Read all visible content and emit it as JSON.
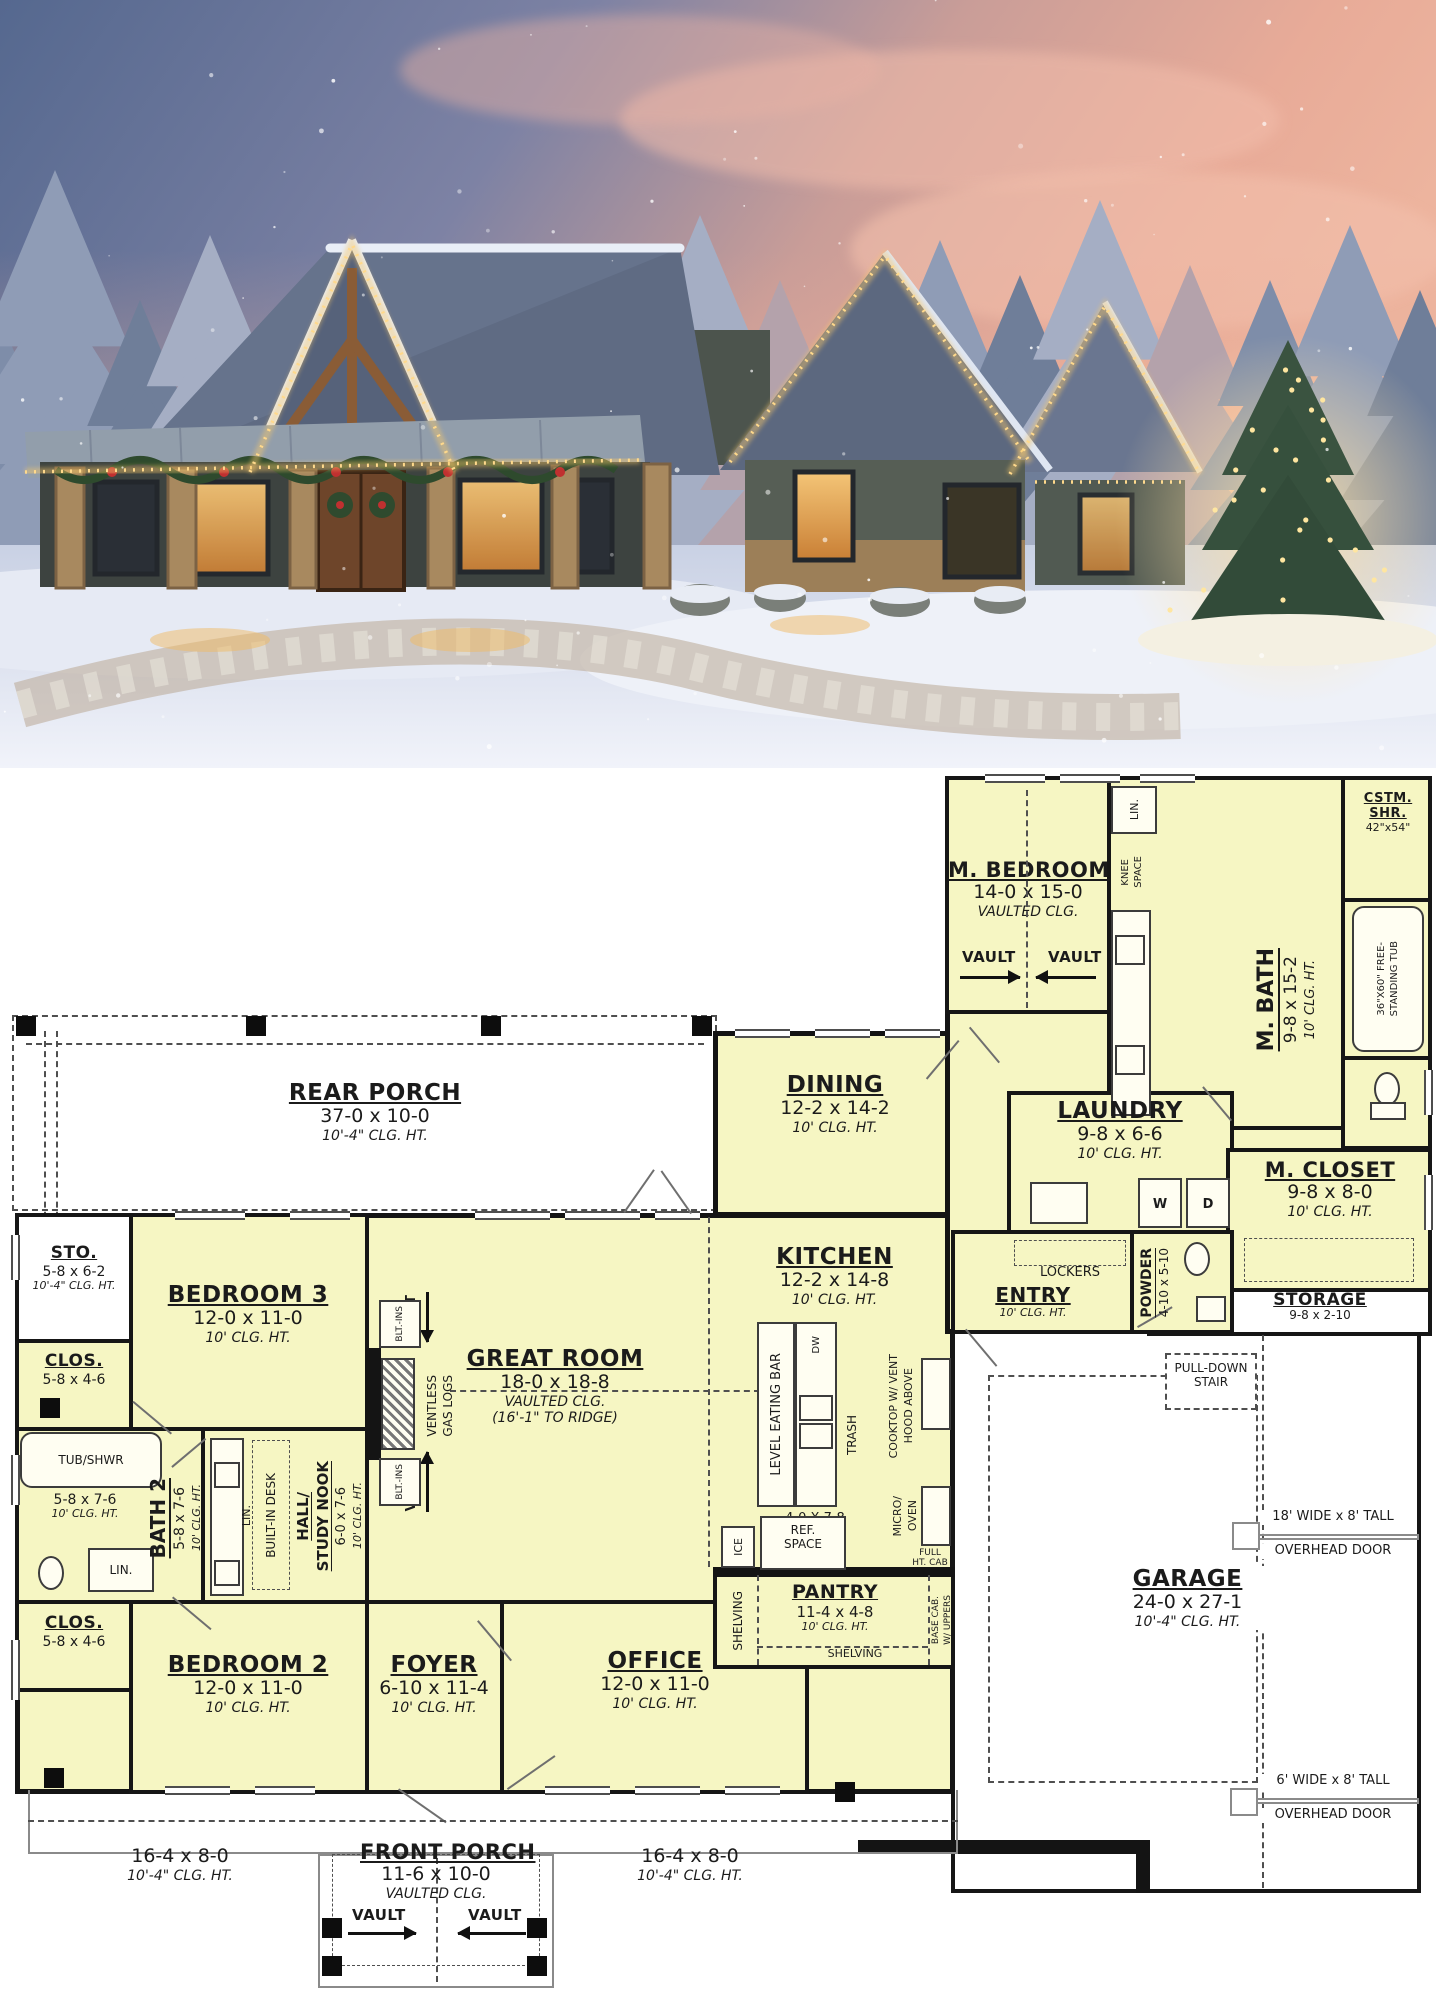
{
  "palette": {
    "plan_room_fill": "#f6f6c3",
    "plan_wall": "#141414",
    "plan_bg": "#ffffff",
    "plan_dash": "#4f4f4f",
    "sky_blue": "#55688f",
    "sky_pink": "#edb49e",
    "tree_frost": "#8795b2",
    "snow": "#e6eaf4",
    "roof_slate": "#5c687f",
    "porch_metal": "#929eb1",
    "stone": "#a8895f",
    "timber": "#8a5c36",
    "window_glow": "#f2c171",
    "lights_warm": "#ffd98c",
    "garland": "#2e4a2d",
    "door_wood": "#6e452a"
  },
  "photo": {
    "scene": "snowy dusk farmhouse with christmas lights and lit tree"
  },
  "plan": {
    "rooms": {
      "rear_porch": {
        "name": "REAR PORCH",
        "dims": "37-0 x 10-0",
        "clg": "10'-4\" CLG. HT."
      },
      "m_bedroom": {
        "name": "M. BEDROOM",
        "dims": "14-0 x 15-0",
        "clg": "VAULTED CLG."
      },
      "m_bath": {
        "name": "M. BATH",
        "dims": "9-8 x 15-2",
        "clg": "10' CLG. HT."
      },
      "cstm_shr": {
        "l1": "CSTM.",
        "l2": "SHR.",
        "dims": "42\"x54\""
      },
      "free_tub": {
        "l1": "36\"X60\" FREE-",
        "l2": "STANDING TUB"
      },
      "dining": {
        "name": "DINING",
        "dims": "12-2 x 14-2",
        "clg": "10' CLG. HT."
      },
      "laundry": {
        "name": "LAUNDRY",
        "dims": "9-8 x 6-6",
        "clg": "10' CLG. HT."
      },
      "m_closet": {
        "name": "M. CLOSET",
        "dims": "9-8 x 8-0",
        "clg": "10' CLG. HT."
      },
      "sto": {
        "name": "STO.",
        "dims": "5-8 x 6-2",
        "clg": "10'-4\" CLG. HT."
      },
      "bedroom3": {
        "name": "BEDROOM 3",
        "dims": "12-0 x 11-0",
        "clg": "10' CLG. HT."
      },
      "clos_top": {
        "name": "CLOS.",
        "dims": "5-8 x 4-6"
      },
      "clos_bottom": {
        "name": "CLOS.",
        "dims": "5-8 x 4-6"
      },
      "bath2": {
        "name": "BATH 2",
        "dims": "5-8 x 7-6",
        "clg": "10' CLG. HT."
      },
      "bath2_inline": {
        "dims": "5-8 x 7-6",
        "clg": "10' CLG. HT."
      },
      "hall": {
        "l1": "HALL/",
        "l2": "STUDY NOOK",
        "dims": "6-0 x 7-6",
        "clg": "10' CLG. HT."
      },
      "great_room": {
        "name": "GREAT ROOM",
        "dims": "18-0 x 18-8",
        "clg": "VAULTED CLG.",
        "clg2": "(16'-1\" TO RIDGE)"
      },
      "kitchen": {
        "name": "KITCHEN",
        "dims": "12-2 x 14-8",
        "clg": "10' CLG. HT."
      },
      "island": {
        "dims": "4-0 X 7-8",
        "name": "ISLAND"
      },
      "pantry": {
        "name": "PANTRY",
        "dims": "11-4 x 4-8",
        "clg": "10' CLG. HT."
      },
      "entry": {
        "name": "ENTRY",
        "clg": "10' CLG. HT."
      },
      "powder": {
        "name": "POWDER",
        "dims": "4-10 x 5-10"
      },
      "storage": {
        "name": "STORAGE",
        "dims": "9-8 x 2-10"
      },
      "garage": {
        "name": "GARAGE",
        "dims": "24-0 x 27-1",
        "clg": "10'-4\" CLG. HT."
      },
      "foyer": {
        "name": "FOYER",
        "dims": "6-10 x 11-4",
        "clg": "10' CLG. HT."
      },
      "bedroom2": {
        "name": "BEDROOM 2",
        "dims": "12-0 x 11-0",
        "clg": "10' CLG. HT."
      },
      "office": {
        "name": "OFFICE",
        "dims": "12-0 x 11-0",
        "clg": "10' CLG. HT."
      },
      "front_porch": {
        "name": "FRONT PORCH",
        "dims": "11-6 x 10-0",
        "clg": "VAULTED CLG."
      },
      "porch_wing_left": {
        "dims": "16-4 x 8-0",
        "clg": "10'-4\" CLG. HT."
      },
      "porch_wing_right": {
        "dims": "16-4 x 8-0",
        "clg": "10'-4\" CLG. HT."
      }
    },
    "labels": {
      "vault": "VAULT",
      "lin": "LIN.",
      "knee1": "KNEE",
      "knee2": "SPACE",
      "tub_shwr": "TUB/SHWR",
      "lockers": "LOCKERS",
      "w": "W",
      "d": "D",
      "dw": "DW",
      "trash": "TRASH",
      "ice": "ICE",
      "blt_ins": "BLT.-INS",
      "ventless1": "VENTLESS",
      "ventless2": "GAS LOGS",
      "built_in_desk": "BUILT-IN DESK",
      "eating_bar": "LEVEL EATING BAR",
      "cooktop1": "COOKTOP W/ VENT",
      "cooktop2": "HOOD ABOVE",
      "micro1": "MICRO/",
      "micro2": "OVEN",
      "full1": "FULL",
      "full2": "HT. CAB",
      "base1": "BASE CAB.",
      "base2": "W/ UPPERS",
      "ref1": "REF.",
      "ref2": "SPACE",
      "shelving": "SHELVING",
      "pull1": "PULL-DOWN",
      "pull2": "STAIR",
      "ohd18_1": "18' WIDE x 8' TALL",
      "ohd18_2": "OVERHEAD DOOR",
      "ohd6_1": "6' WIDE x 8' TALL",
      "ohd6_2": "OVERHEAD DOOR"
    }
  }
}
